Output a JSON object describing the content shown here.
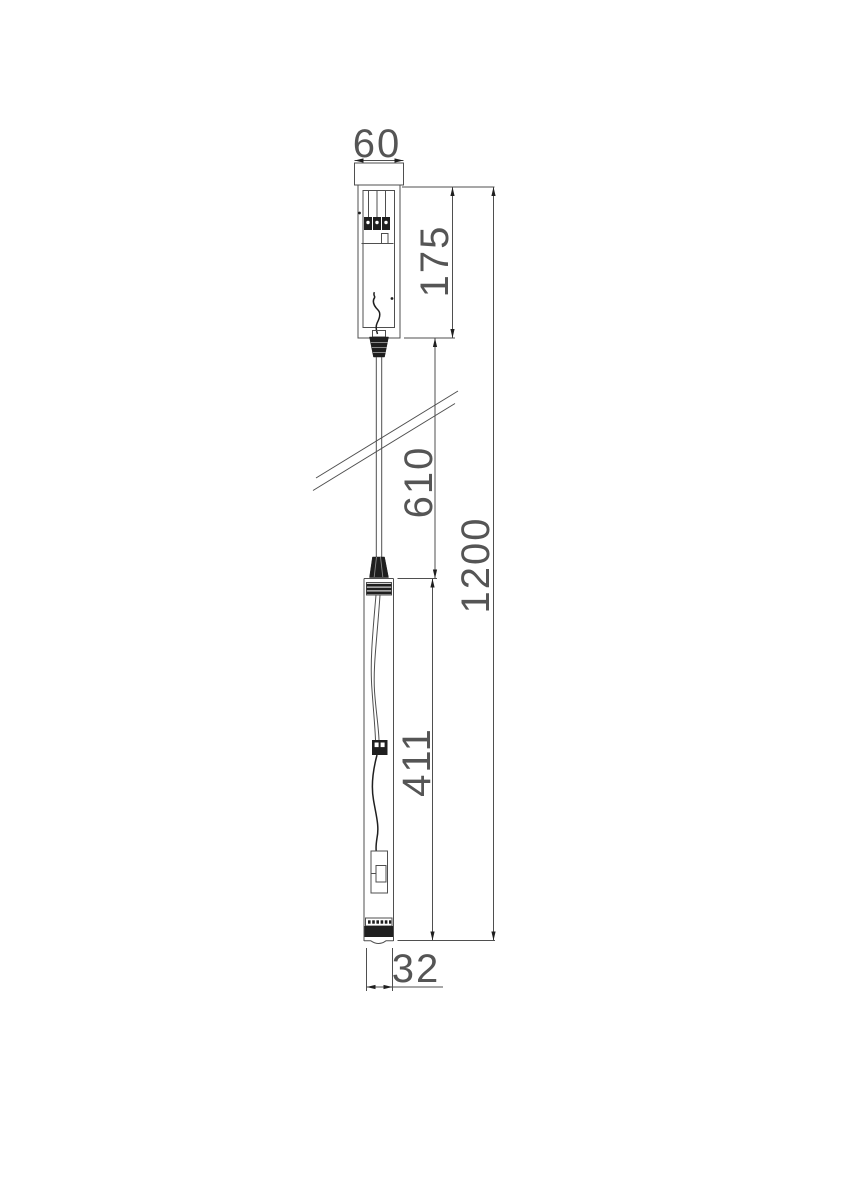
{
  "dimensions": {
    "canopy_width": "60",
    "canopy_height": "175",
    "cable_length": "610",
    "lamp_length": "411",
    "total_height": "1200",
    "lamp_width": "32"
  },
  "style": {
    "line_color": "#4f4f4f",
    "dark_fill": "#1f1f1f",
    "text_color": "#555555",
    "background": "#ffffff"
  }
}
